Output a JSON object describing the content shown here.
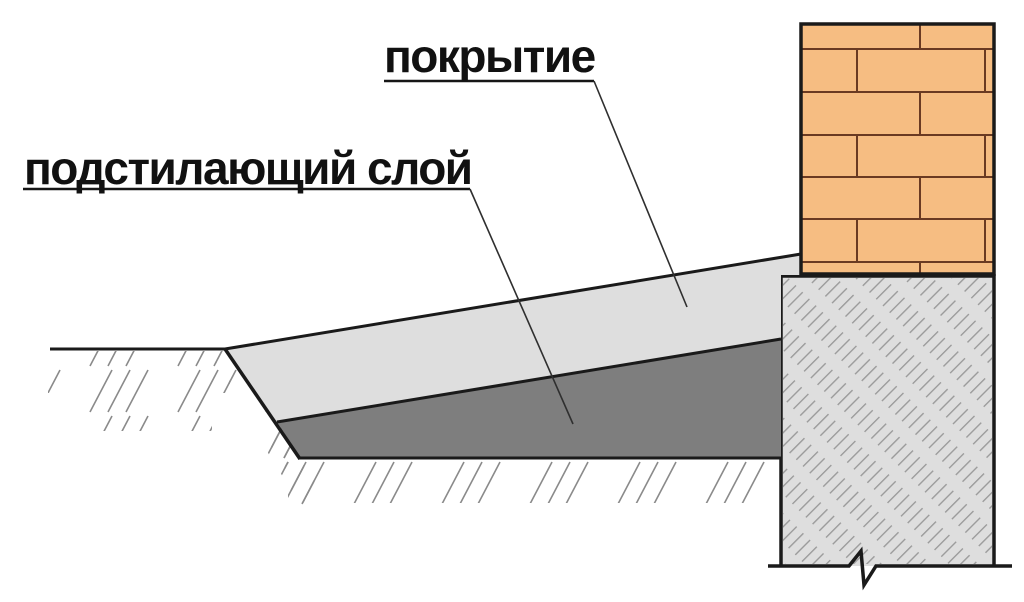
{
  "labels": {
    "covering": "покрытие",
    "underlying_layer": "подстилающий слой"
  },
  "colors": {
    "background": "#ffffff",
    "brick_fill": "#f6bd82",
    "brick_joint": "#6a3a22",
    "covering_fill": "#dedede",
    "underlying_fill": "#7e7e7e",
    "foundation_fill": "#dedede",
    "ground_hatch": "#8a8a8a",
    "concrete_hatch": "#9a9a9a",
    "outline": "#1a1a1a",
    "label_text": "#111111"
  }
}
